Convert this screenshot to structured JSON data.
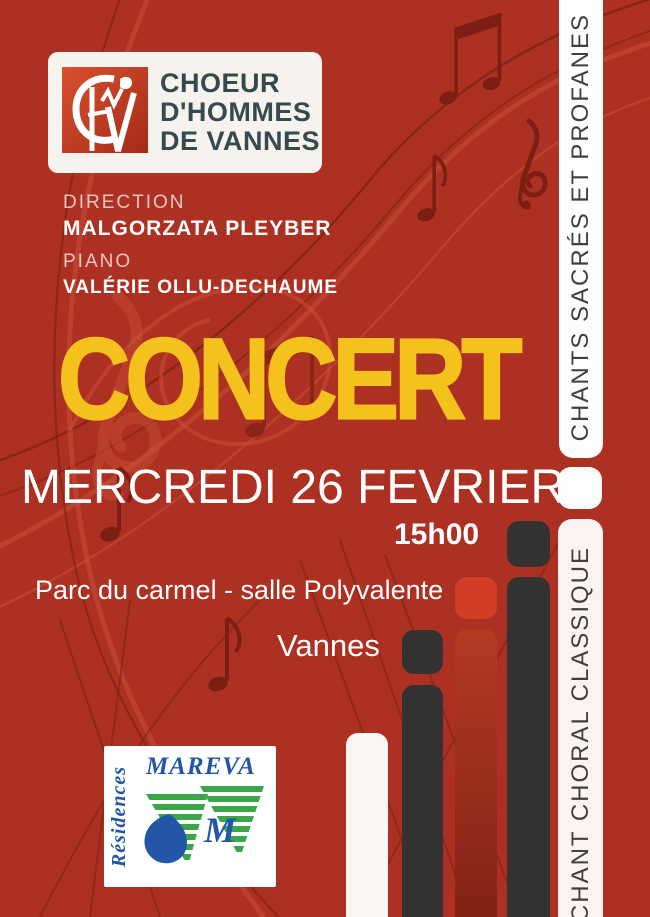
{
  "logo": {
    "line1": "CHOEUR",
    "line2": "D'HOMMES",
    "line3": "DE VANNES"
  },
  "credits": {
    "direction_label": "DIRECTION",
    "direction_name": "MALGORZATA PLEYBER",
    "piano_label": "PIANO",
    "piano_name": "VALÉRIE OLLU-DECHAUME"
  },
  "event": {
    "title": "CONCERT",
    "date": "MERCREDI 26 FEVRIER",
    "time": "15h00",
    "venue": "Parc du carmel - salle Polyvalente",
    "city": "Vannes"
  },
  "ribbons": {
    "top": "CHANTS SACRÉS ET PROFANES",
    "bottom": "CHANT CHORAL CLASSIQUE"
  },
  "sponsor": {
    "brand": "MAREVA",
    "label": "Résidences",
    "monogram": "M"
  },
  "icons": {
    "treble_clef": "stylized G-clef spiral",
    "eighth_note": "♪",
    "beamed_notes": "♫"
  },
  "colors": {
    "background": "#AC3122",
    "title_yellow": "#F4C11D",
    "bar_dark": "#333231",
    "bar_red": "#D23D26",
    "ribbon_white": "#FDFDFD",
    "ribbon_offwhite": "#FBF3F1",
    "ribbon_text": "#3F3F3F",
    "logo_text": "#344A4E",
    "note_dark": "#7C1F12",
    "note_light": "#C9523A",
    "mareva_blue": "#2456A8",
    "mareva_green": "#3AA648"
  }
}
